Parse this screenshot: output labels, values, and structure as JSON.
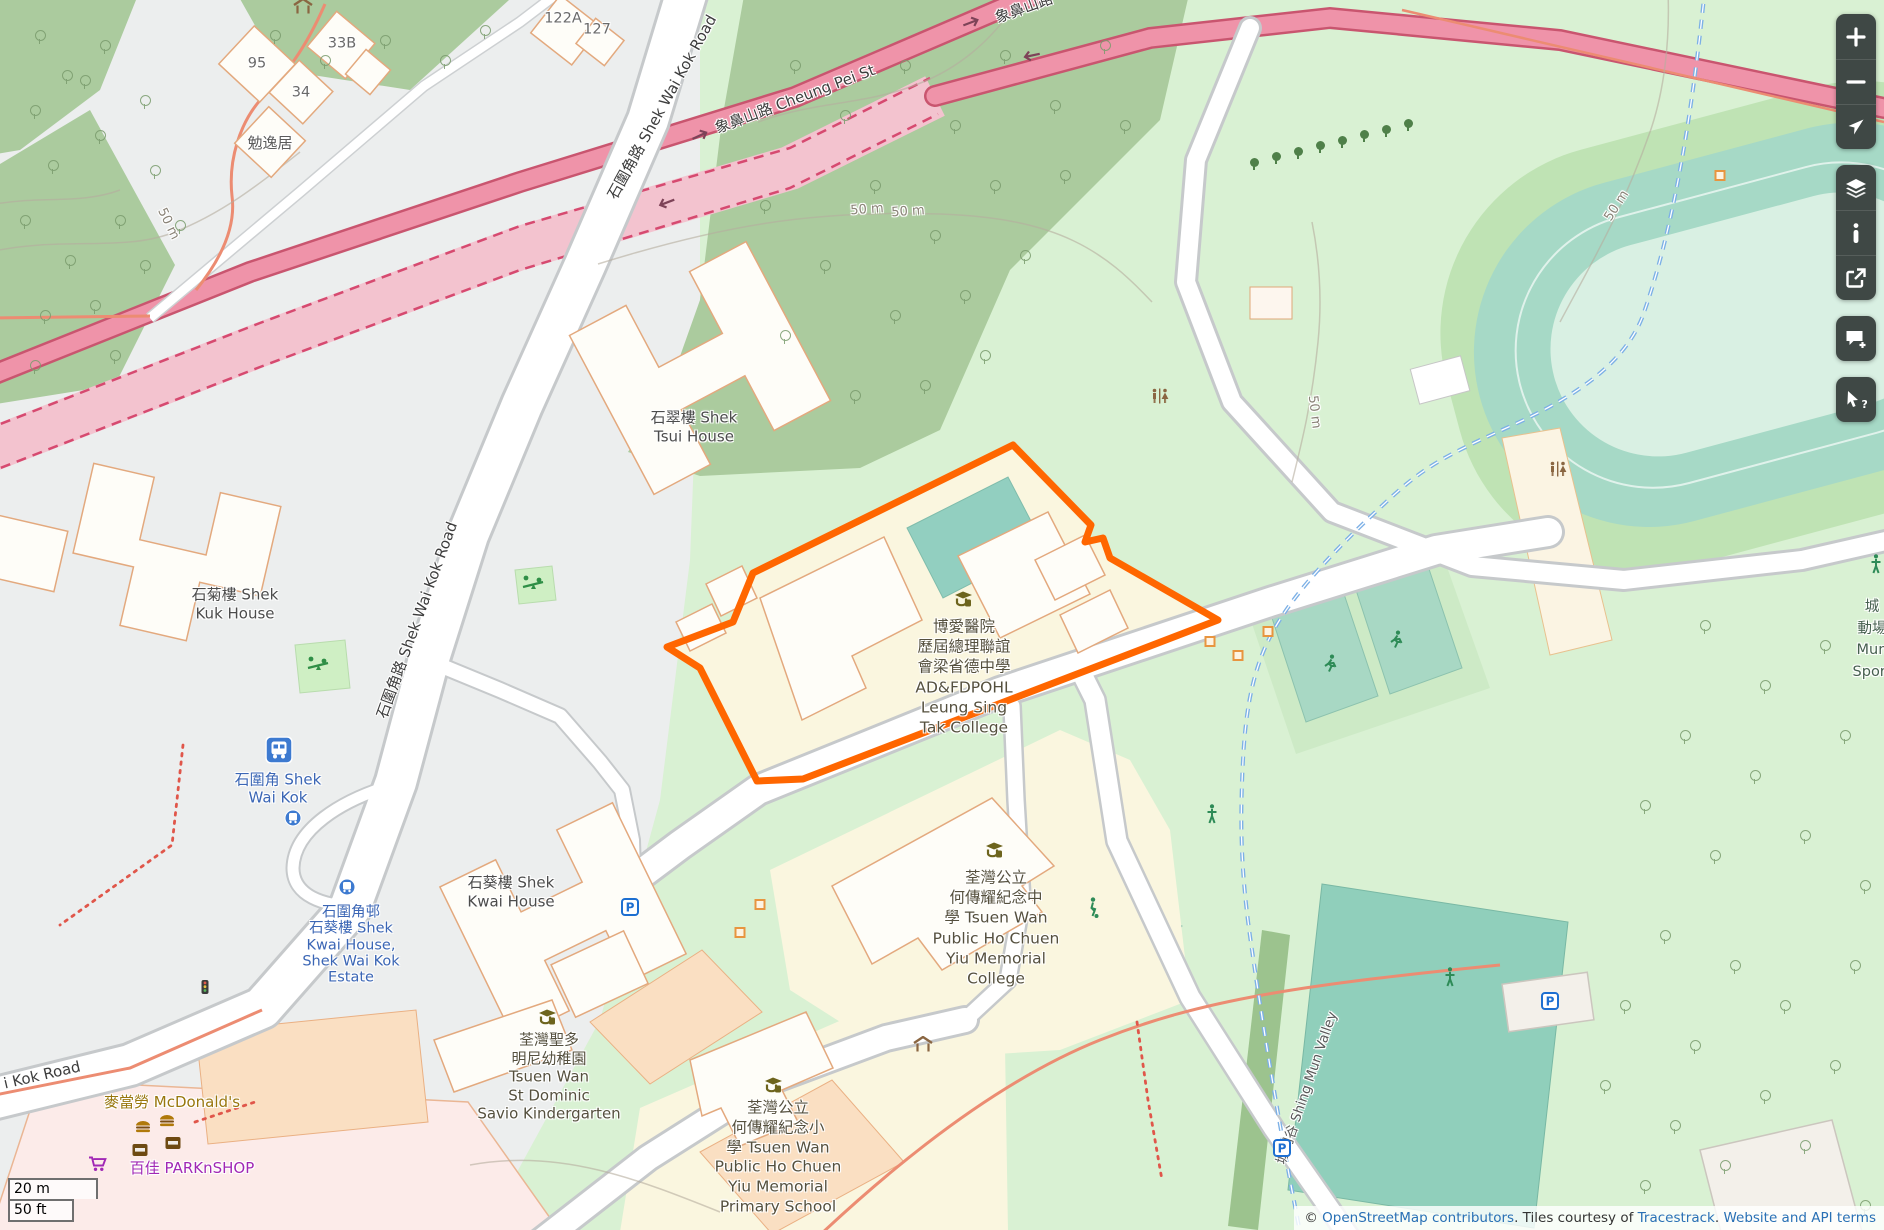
{
  "canvas": {
    "width": 1884,
    "height": 1230
  },
  "colors": {
    "highlight_orange": "#ff6600",
    "trunk_road_pink": "#ef93a9",
    "trunk_casing": "#c9556f",
    "tunnel_pink": "#f3c3cf",
    "water_path_blue": "#7cb0e6",
    "transit_label_blue": "#3b66b5",
    "school_area_yellow": "#faf6df",
    "forest_green": "#abcb9e",
    "pitch_teal": "#a8d8c4",
    "control_bg": "#3f4845",
    "link_blue": "#2970b5",
    "mcdonalds_gold": "#99770e",
    "parknshop_purple": "#a128b5"
  },
  "controls": {
    "groups": [
      {
        "buttons": [
          {
            "id": "zoom-in",
            "icon": "plus-icon"
          },
          {
            "id": "zoom-out",
            "icon": "minus-icon"
          },
          {
            "id": "locate",
            "icon": "navigation-arrow-icon"
          }
        ]
      },
      {
        "buttons": [
          {
            "id": "layers",
            "icon": "layers-icon"
          },
          {
            "id": "map-info",
            "icon": "info-icon"
          },
          {
            "id": "share",
            "icon": "share-icon"
          }
        ]
      },
      {
        "buttons": [
          {
            "id": "add-note",
            "icon": "comment-plus-icon"
          }
        ]
      },
      {
        "buttons": [
          {
            "id": "query-features",
            "icon": "query-cursor-icon"
          }
        ]
      }
    ]
  },
  "scalebar": {
    "metric": "20 m",
    "imperial": "50 ft"
  },
  "attribution": {
    "prefix": "© ",
    "osm_link": "OpenStreetMap contributors",
    "middle": ". Tiles courtesy of ",
    "tiles_link": "Tracestrack",
    "separator": ". ",
    "terms_link": "Website and API terms"
  },
  "labels": [
    {
      "name": "road-label-shek-wai-kok-top",
      "lines": [
        "石圍角路 Shek Wai Kok Road"
      ],
      "x": 662,
      "y": 107,
      "rot": -61,
      "size": 15,
      "color": "#3d3d3d"
    },
    {
      "name": "road-label-cheung-pei",
      "lines": [
        "象鼻山路 Cheung Pei St"
      ],
      "x": 795,
      "y": 99,
      "rot": -20.5,
      "size": 15,
      "color": "#3d3d3d"
    },
    {
      "name": "road-label-cheung-pei-cut",
      "lines": [
        "象鼻山路"
      ],
      "x": 1024,
      "y": 8,
      "rot": -20,
      "size": 15,
      "color": "#3d3d3d"
    },
    {
      "name": "road-label-shek-wai-kok-mid",
      "lines": [
        "石圍角路 Shek Wai Kok Road"
      ],
      "x": 417,
      "y": 620,
      "rot": -70,
      "size": 15,
      "color": "#3d3d3d"
    },
    {
      "name": "road-label-kok-road-cut",
      "lines": [
        "i Kok Road"
      ],
      "x": 42,
      "y": 1075,
      "rot": -13,
      "size": 15,
      "color": "#3d3d3d"
    },
    {
      "name": "contour-label-50m-a",
      "lines": [
        "50 m"
      ],
      "x": 867,
      "y": 210,
      "rot": -4,
      "size": 13,
      "color": "#8a8377"
    },
    {
      "name": "contour-label-50m-b",
      "lines": [
        "50 m"
      ],
      "x": 908,
      "y": 212,
      "rot": -4,
      "size": 13,
      "color": "#8a8377"
    },
    {
      "name": "contour-label-50m-left",
      "lines": [
        "50 m"
      ],
      "x": 168,
      "y": 224,
      "rot": 64,
      "size": 13,
      "color": "#8a8377"
    },
    {
      "name": "contour-label-50m-right",
      "lines": [
        "50 m"
      ],
      "x": 1617,
      "y": 206,
      "rot": -57,
      "size": 13,
      "color": "#8a8377"
    },
    {
      "name": "contour-label-50m-mid",
      "lines": [
        "50 m"
      ],
      "x": 1314,
      "y": 412,
      "rot": 83,
      "size": 13,
      "color": "#8a8377"
    },
    {
      "name": "housenumber-95",
      "lines": [
        "95"
      ],
      "x": 257,
      "y": 64,
      "size": 14.5,
      "color": "#6a6a6a"
    },
    {
      "name": "housenumber-34",
      "lines": [
        "34"
      ],
      "x": 301,
      "y": 93,
      "size": 14.5,
      "color": "#6a6a6a"
    },
    {
      "name": "housenumber-33b",
      "lines": [
        "33B"
      ],
      "x": 342,
      "y": 44,
      "size": 14.5,
      "color": "#6a6a6a"
    },
    {
      "name": "housenumber-122a",
      "lines": [
        "122A"
      ],
      "x": 563,
      "y": 19,
      "size": 14.5,
      "color": "#6a6a6a"
    },
    {
      "name": "housenumber-127",
      "lines": [
        "127"
      ],
      "x": 597,
      "y": 30,
      "size": 14.5,
      "color": "#6a6a6a"
    },
    {
      "name": "housename-min-yat-kui",
      "lines": [
        "勉逸居"
      ],
      "x": 270,
      "y": 143,
      "size": 15,
      "color": "#5b5b5b"
    },
    {
      "name": "building-label-shek-tsui-house",
      "lines": [
        "石翠樓 Shek",
        "Tsui House"
      ],
      "x": 694,
      "y": 427,
      "size": 15,
      "lh": 18.5,
      "color": "#4c4c4c"
    },
    {
      "name": "building-label-shek-kuk-house",
      "lines": [
        "石菊樓 Shek",
        "Kuk House"
      ],
      "x": 235,
      "y": 604,
      "size": 15,
      "lh": 18.5,
      "color": "#4c4c4c"
    },
    {
      "name": "building-label-shek-kwai-house",
      "lines": [
        "石葵樓 Shek",
        "Kwai House"
      ],
      "x": 511,
      "y": 892,
      "size": 15,
      "lh": 18.5,
      "color": "#4c4c4c"
    },
    {
      "name": "transit-label-shek-wai-kok",
      "lines": [
        "石圍角 Shek",
        "Wai Kok"
      ],
      "x": 278,
      "y": 789,
      "size": 15,
      "lh": 17.5,
      "color": "#3b66b5"
    },
    {
      "name": "transit-label-shek-wai-kok-estate",
      "lines": [
        "石圍角邨",
        "石葵樓 Shek",
        "Kwai House,",
        "Shek Wai Kok",
        "Estate"
      ],
      "x": 351,
      "y": 945,
      "size": 14.5,
      "lh": 16.3,
      "color": "#3b66b5"
    },
    {
      "name": "poi-label-mcdonalds",
      "lines": [
        "麥當勞 McDonald's"
      ],
      "x": 172,
      "y": 1102,
      "size": 15,
      "color": "#99770e"
    },
    {
      "name": "poi-label-parknshop",
      "lines": [
        "百佳 PARKnSHOP"
      ],
      "x": 192,
      "y": 1168,
      "size": 15,
      "color": "#a128b5"
    },
    {
      "name": "school-label-leung-sing-tak-college",
      "lines": [
        "博愛醫院",
        "歷屆總理聯誼",
        "會梁省德中學",
        "AD&FDPOHL",
        "Leung Sing",
        "Tak College"
      ],
      "x": 964,
      "y": 677,
      "size": 15.5,
      "lh": 20.2,
      "color": "#55503e"
    },
    {
      "name": "school-label-ho-chuen-yiu-college",
      "lines": [
        "荃灣公立",
        "何傳耀紀念中",
        "學 Tsuen Wan",
        "Public Ho Chuen",
        "Yiu Memorial",
        "College"
      ],
      "x": 996,
      "y": 928,
      "size": 15.5,
      "lh": 20.2,
      "color": "#55503e"
    },
    {
      "name": "school-label-st-dominic-savio-kindergarten",
      "lines": [
        "荃灣聖多",
        "明尼幼稚園",
        "Tsuen Wan",
        "St Dominic",
        "Savio Kindergarten"
      ],
      "x": 549,
      "y": 1077,
      "size": 15,
      "lh": 18.6,
      "color": "#55503e"
    },
    {
      "name": "school-label-ho-chuen-yiu-primary",
      "lines": [
        "荃灣公立",
        "何傳耀紀念小",
        "學 Tsuen Wan",
        "Public Ho Chuen",
        "Yiu Memorial",
        "Primary School"
      ],
      "x": 778,
      "y": 1158,
      "size": 15.5,
      "lh": 19.8,
      "color": "#55503e"
    },
    {
      "name": "area-label-shing-mun-valley",
      "lines": [
        "城門谷 Shing Mun Valley"
      ],
      "x": 1307,
      "y": 1088,
      "rot": -71,
      "size": 13.5,
      "color": "#595959"
    },
    {
      "name": "area-label-sports-ground-cut",
      "lines": [
        "城",
        "動場",
        "Mun",
        "Sport"
      ],
      "x": 1872,
      "y": 640,
      "size": 14.5,
      "lh": 21.5,
      "color": "#46604f"
    }
  ],
  "icons": [
    {
      "type": "school",
      "x": 963,
      "y": 601
    },
    {
      "type": "school",
      "x": 994,
      "y": 852
    },
    {
      "type": "school",
      "x": 547,
      "y": 1019
    },
    {
      "type": "school",
      "x": 773,
      "y": 1087
    },
    {
      "type": "playground",
      "x": 318,
      "y": 665
    },
    {
      "type": "playground",
      "x": 533,
      "y": 584
    },
    {
      "type": "bus-station",
      "x": 279,
      "y": 752
    },
    {
      "type": "bus-stop",
      "x": 293,
      "y": 820
    },
    {
      "type": "bus-stop",
      "x": 347,
      "y": 889
    },
    {
      "type": "parking",
      "x": 630,
      "y": 909
    },
    {
      "type": "parking",
      "x": 1282,
      "y": 1150
    },
    {
      "type": "parking",
      "x": 1550,
      "y": 1003
    },
    {
      "type": "toilets",
      "x": 1558,
      "y": 471
    },
    {
      "type": "toilets",
      "x": 1160,
      "y": 398
    },
    {
      "type": "shelter",
      "x": 303,
      "y": 8
    },
    {
      "type": "shelter",
      "x": 923,
      "y": 1046
    },
    {
      "type": "burger",
      "x": 143,
      "y": 1127
    },
    {
      "type": "burger",
      "x": 167,
      "y": 1121
    },
    {
      "type": "convenience",
      "x": 140,
      "y": 1151
    },
    {
      "type": "convenience",
      "x": 173,
      "y": 1144
    },
    {
      "type": "cart",
      "x": 98,
      "y": 1166
    },
    {
      "type": "runner",
      "x": 1330,
      "y": 666
    },
    {
      "type": "runner",
      "x": 1396,
      "y": 642
    },
    {
      "type": "soccer-player",
      "x": 1093,
      "y": 910
    },
    {
      "type": "person",
      "x": 1212,
      "y": 816
    },
    {
      "type": "person",
      "x": 1450,
      "y": 979
    },
    {
      "type": "person",
      "x": 1876,
      "y": 566
    },
    {
      "type": "traffic-signal",
      "x": 205,
      "y": 989
    },
    {
      "type": "oneway-right",
      "x": 700,
      "y": 136,
      "rot": -25
    },
    {
      "type": "oneway-right",
      "x": 971,
      "y": 23,
      "rot": -21
    },
    {
      "type": "oneway-left",
      "x": 667,
      "y": 203,
      "rot": -21
    },
    {
      "type": "oneway-left",
      "x": 1032,
      "y": 56,
      "rot": -12
    },
    {
      "type": "marker-square",
      "x": 1720,
      "y": 176
    },
    {
      "type": "marker-square",
      "x": 1210,
      "y": 642
    },
    {
      "type": "marker-square",
      "x": 1238,
      "y": 656
    },
    {
      "type": "marker-square",
      "x": 1268,
      "y": 632
    },
    {
      "type": "marker-square",
      "x": 760,
      "y": 905
    },
    {
      "type": "marker-square",
      "x": 740,
      "y": 933
    }
  ],
  "trees": {
    "pins": [
      [
        30,
        105
      ],
      [
        62,
        70
      ],
      [
        100,
        40
      ],
      [
        48,
        160
      ],
      [
        95,
        130
      ],
      [
        140,
        95
      ],
      [
        20,
        215
      ],
      [
        65,
        255
      ],
      [
        115,
        215
      ],
      [
        150,
        165
      ],
      [
        40,
        310
      ],
      [
        90,
        300
      ],
      [
        140,
        260
      ],
      [
        175,
        220
      ],
      [
        30,
        360
      ],
      [
        110,
        350
      ],
      [
        35,
        30
      ],
      [
        80,
        75
      ],
      [
        270,
        30
      ],
      [
        320,
        55
      ],
      [
        380,
        35
      ],
      [
        440,
        55
      ],
      [
        480,
        25
      ],
      [
        790,
        60
      ],
      [
        840,
        110
      ],
      [
        900,
        60
      ],
      [
        950,
        120
      ],
      [
        1000,
        50
      ],
      [
        1050,
        100
      ],
      [
        1100,
        40
      ],
      [
        870,
        180
      ],
      [
        930,
        230
      ],
      [
        990,
        180
      ],
      [
        1060,
        170
      ],
      [
        1120,
        120
      ],
      [
        820,
        260
      ],
      [
        890,
        310
      ],
      [
        960,
        290
      ],
      [
        1020,
        250
      ],
      [
        760,
        200
      ],
      [
        780,
        330
      ],
      [
        850,
        390
      ],
      [
        920,
        380
      ],
      [
        980,
        350
      ],
      [
        1700,
        620
      ],
      [
        1760,
        680
      ],
      [
        1820,
        640
      ],
      [
        1680,
        730
      ],
      [
        1750,
        770
      ],
      [
        1840,
        730
      ],
      [
        1640,
        800
      ],
      [
        1710,
        850
      ],
      [
        1800,
        830
      ],
      [
        1860,
        880
      ],
      [
        1660,
        930
      ],
      [
        1730,
        960
      ],
      [
        1620,
        1000
      ],
      [
        1690,
        1040
      ],
      [
        1780,
        1000
      ],
      [
        1850,
        960
      ],
      [
        1600,
        1080
      ],
      [
        1670,
        1120
      ],
      [
        1760,
        1090
      ],
      [
        1830,
        1060
      ],
      [
        1640,
        1180
      ],
      [
        1720,
        1160
      ],
      [
        1800,
        1140
      ],
      [
        1860,
        1200
      ]
    ],
    "row": [
      [
        1250,
        158
      ],
      [
        1272,
        152
      ],
      [
        1294,
        147
      ],
      [
        1316,
        141
      ],
      [
        1338,
        136
      ],
      [
        1360,
        130
      ],
      [
        1382,
        125
      ],
      [
        1404,
        119
      ]
    ]
  }
}
